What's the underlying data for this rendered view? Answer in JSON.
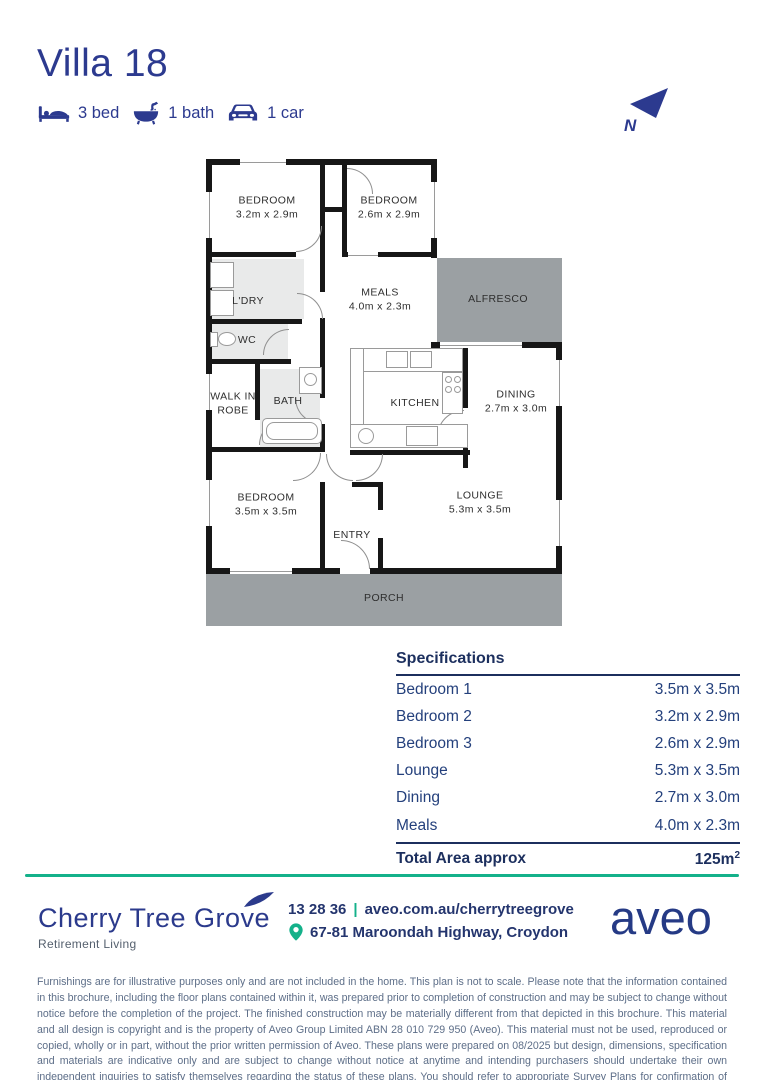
{
  "header": {
    "title": "Villa 18",
    "features": {
      "bed": "3 bed",
      "bath": "1 bath",
      "car": "1 car"
    },
    "compass_label": "N"
  },
  "colors": {
    "navy": "#2b3a8c",
    "navy_dark": "#1c2f5e",
    "teal": "#14b18a",
    "plan_gray": "#9ba0a3",
    "plan_light_gray": "#e9eaea",
    "muted_text": "#5d6e88"
  },
  "plan": {
    "rooms": {
      "bed_top_left": {
        "name": "BEDROOM",
        "dims": "3.2m x 2.9m"
      },
      "bed_top_right": {
        "name": "BEDROOM",
        "dims": "2.6m x 2.9m"
      },
      "bed_bottom": {
        "name": "BEDROOM",
        "dims": "3.5m x 3.5m"
      },
      "laundry": {
        "name": "L'DRY"
      },
      "wc": {
        "name": "WC"
      },
      "meals": {
        "name": "MEALS",
        "dims": "4.0m x 2.3m"
      },
      "alfresco": {
        "name": "ALFRESCO"
      },
      "walk_in_robe": {
        "name": "WALK IN ROBE"
      },
      "bath": {
        "name": "BATH"
      },
      "kitchen": {
        "name": "KITCHEN"
      },
      "dining": {
        "name": "DINING",
        "dims": "2.7m x 3.0m"
      },
      "entry": {
        "name": "ENTRY"
      },
      "lounge": {
        "name": "LOUNGE",
        "dims": "5.3m x 3.5m"
      },
      "porch": {
        "name": "PORCH"
      }
    }
  },
  "specs": {
    "heading": "Specifications",
    "rows": [
      {
        "label": "Bedroom 1",
        "value": "3.5m x 3.5m"
      },
      {
        "label": "Bedroom 2",
        "value": "3.2m x 2.9m"
      },
      {
        "label": "Bedroom 3",
        "value": "2.6m x 2.9m"
      },
      {
        "label": "Lounge",
        "value": "5.3m x 3.5m"
      },
      {
        "label": "Dining",
        "value": "2.7m x 3.0m"
      },
      {
        "label": "Meals",
        "value": "4.0m x 2.3m"
      }
    ],
    "total_label": "Total Area approx",
    "total_value": "125m",
    "total_sup": "2"
  },
  "footer": {
    "community_name": "Cherry Tree Grove",
    "community_tagline": "Retirement Living",
    "phone": "13 28 36",
    "separator": "|",
    "website": "aveo.com.au/cherrytreegrove",
    "address": "67-81 Maroondah Highway, Croydon",
    "brand": "aveo"
  },
  "disclaimer": {
    "text": "Furnishings are for illustrative purposes only and are not included in the home. This plan is not to scale. Please note that the information contained in this brochure, including the floor plans contained within it, was prepared prior to completion of construction and may be subject to change without notice before the completion of the project. The finished construction may be materially different from that depicted in this brochure. This material and all design is copyright and is the property of Aveo Group Limited ABN 28 010 729 950 (Aveo). This material must not be used, reproduced or copied, wholly or in part, without the prior written permission of Aveo. These plans were prepared on 08/2025 but design, dimensions, specification and materials are indicative only and are subject to change without notice at anytime and intending purchasers should undertake their own independent inquiries to satisfy themselves regarding the status of these plans. You should refer to appropriate Survey Plans for confirmation of individual unit areas."
  }
}
